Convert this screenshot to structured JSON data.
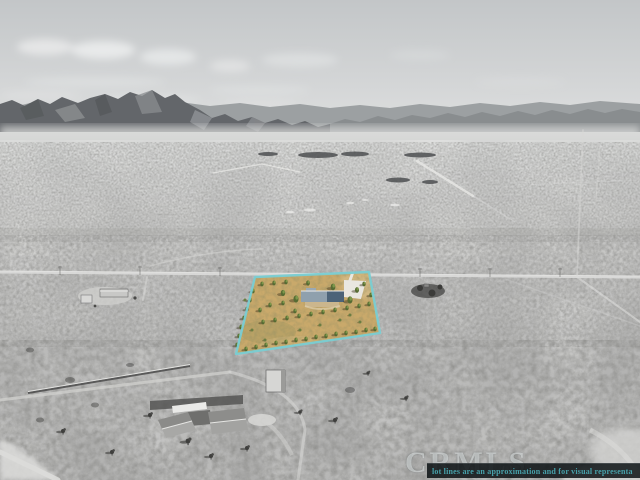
{
  "overlay": {
    "watermark_text": "CRMLS",
    "disclaimer_text": "lot lines are an approximation and for visual representa",
    "disclaimer_text_color": "#47a1aa",
    "disclaimer_bg_color": "rgba(10,15,18,0.84)"
  },
  "lot": {
    "boundary_color": "#79cdd3"
  }
}
